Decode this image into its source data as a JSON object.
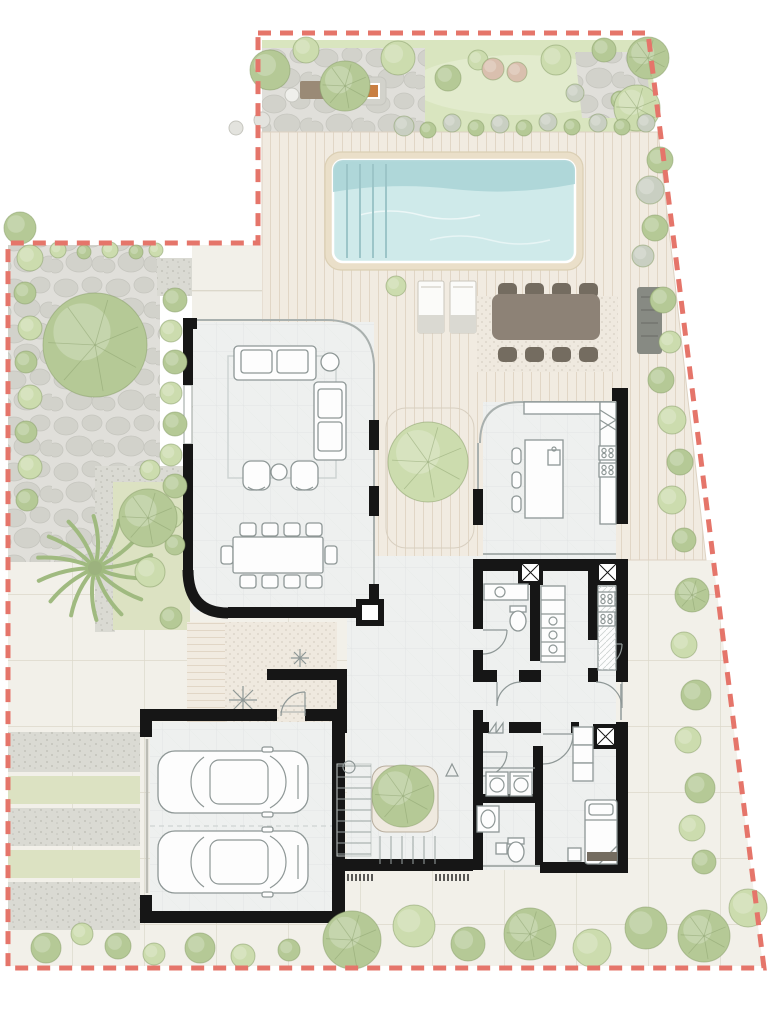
{
  "meta": {
    "title": "villa-landscape-floor-plan",
    "canvas": {
      "width": 768,
      "height": 1019
    }
  },
  "palette": {
    "boundary": "#e5756a",
    "lawn": "#d9e5bf",
    "lawnLight": "#e6eed3",
    "deck": "#f1ebe1",
    "deckLine": "#e1d6c6",
    "pave": "#f2f0e9",
    "paveLine": "#dcd8cb",
    "stoneBase": "#e0dfda",
    "stone": "#d2d2cb",
    "stoneLine": "#c6c6bf",
    "gravel": "#dadad3",
    "gravelDot": "#c3c3bb",
    "bedGreen": "#dce2c2",
    "poolBorder": "#eadfc9",
    "poolWater": "#cfeaea",
    "poolDeep": "#a9d4d6",
    "poolLane": "#9cc5c8",
    "wall": "#161616",
    "floor": "#eef0ef",
    "floorLine": "#e1e5e4",
    "furn": "#8e9796",
    "furnFill": "#fdfdfd",
    "darkTable": "#8d8276",
    "darkChair": "#746c60",
    "benchGrey": "#878a83",
    "treeLight": "#ccdcae",
    "treeMid": "#b5c996",
    "treeDark": "#9cb27e",
    "treeBlush": "#d9bfae",
    "treeGrey": "#c9cfc2",
    "treeLine": "#8aa06c",
    "palm": "#a0ba80",
    "rock": "#e3e3de",
    "rockLine": "#c6c6bf",
    "matCream": "#efe9df",
    "dot": "#d7d0c3",
    "ember": "#c97f42",
    "bbqBrown": "#9a8a76"
  },
  "boundary": {
    "points": "258,33 648,33 764,968 8,968 8,243 258,243 258,33",
    "dash": "13 9",
    "stroke_width": 5
  },
  "pool": {
    "outer": [
      325,
      152,
      258,
      118
    ],
    "inner": [
      333,
      160,
      242,
      102
    ],
    "lanes_x": [
      347,
      360,
      373,
      386
    ],
    "lane_y1": 164,
    "lane_y2": 258
  },
  "loungers": [
    {
      "x": 418,
      "y": 281
    },
    {
      "x": 450,
      "y": 281
    }
  ],
  "outdoor_dining": {
    "rug": [
      477,
      296,
      141,
      76
    ],
    "table": [
      492,
      294,
      108,
      46
    ],
    "chair_xs": [
      498,
      525,
      552,
      579
    ],
    "chair_y_top": 283,
    "chair_y_bottom": 347
  },
  "bench": [
    637,
    287,
    25,
    67
  ],
  "bbq": {
    "counter": [
      300,
      81,
      35,
      18
    ],
    "pit": [
      358,
      77,
      28,
      28
    ],
    "ember": [
      366,
      85,
      12,
      12
    ]
  },
  "driveway_bands": [
    [
      732,
      40,
      "gravel"
    ],
    [
      776,
      28,
      "green"
    ],
    [
      808,
      38,
      "gravel"
    ],
    [
      850,
      28,
      "green"
    ],
    [
      882,
      48,
      "gravel"
    ]
  ],
  "trees": [
    [
      270,
      70,
      20,
      "mid",
      0
    ],
    [
      306,
      50,
      13,
      "light",
      0
    ],
    [
      345,
      86,
      25,
      "mid",
      1
    ],
    [
      398,
      58,
      17,
      "light",
      0
    ],
    [
      448,
      78,
      13,
      "mid",
      0
    ],
    [
      478,
      60,
      10,
      "light",
      0
    ],
    [
      493,
      69,
      11,
      "blush",
      0
    ],
    [
      517,
      72,
      10,
      "blush",
      0
    ],
    [
      556,
      60,
      15,
      "light",
      0
    ],
    [
      604,
      50,
      12,
      "mid",
      0
    ],
    [
      648,
      58,
      21,
      "mid",
      1
    ],
    [
      575,
      93,
      9,
      "grey",
      0
    ],
    [
      620,
      100,
      9,
      "mid",
      0
    ],
    [
      637,
      108,
      23,
      "light",
      1
    ],
    [
      660,
      160,
      13,
      "mid",
      0
    ],
    [
      650,
      190,
      14,
      "grey",
      0
    ],
    [
      655,
      228,
      13,
      "mid",
      0
    ],
    [
      643,
      256,
      11,
      "grey",
      0
    ],
    [
      663,
      300,
      13,
      "mid",
      0
    ],
    [
      670,
      342,
      11,
      "light",
      0
    ],
    [
      661,
      380,
      13,
      "mid",
      0
    ],
    [
      672,
      420,
      14,
      "light",
      0
    ],
    [
      680,
      462,
      13,
      "mid",
      0
    ],
    [
      672,
      500,
      14,
      "light",
      0
    ],
    [
      684,
      540,
      12,
      "mid",
      0
    ],
    [
      692,
      595,
      17,
      "mid",
      1
    ],
    [
      684,
      645,
      13,
      "light",
      0
    ],
    [
      696,
      695,
      15,
      "mid",
      0
    ],
    [
      688,
      740,
      13,
      "light",
      0
    ],
    [
      700,
      788,
      15,
      "mid",
      0
    ],
    [
      692,
      828,
      13,
      "light",
      0
    ],
    [
      704,
      862,
      12,
      "mid",
      0
    ],
    [
      352,
      940,
      29,
      "mid",
      1
    ],
    [
      414,
      926,
      21,
      "light",
      0
    ],
    [
      468,
      944,
      17,
      "mid",
      0
    ],
    [
      530,
      934,
      26,
      "mid",
      1
    ],
    [
      592,
      948,
      19,
      "light",
      0
    ],
    [
      646,
      928,
      21,
      "mid",
      0
    ],
    [
      704,
      936,
      26,
      "mid",
      1
    ],
    [
      748,
      908,
      19,
      "light",
      0
    ],
    [
      46,
      948,
      15,
      "mid",
      0
    ],
    [
      82,
      934,
      11,
      "light",
      0
    ],
    [
      118,
      946,
      13,
      "mid",
      0
    ],
    [
      154,
      954,
      11,
      "light",
      0
    ],
    [
      200,
      948,
      15,
      "mid",
      0
    ],
    [
      243,
      956,
      12,
      "light",
      0
    ],
    [
      289,
      950,
      11,
      "mid",
      0
    ],
    [
      20,
      228,
      16,
      "mid",
      0
    ],
    [
      30,
      258,
      13,
      "light",
      0
    ],
    [
      25,
      293,
      11,
      "mid",
      0
    ],
    [
      30,
      328,
      12,
      "light",
      0
    ],
    [
      26,
      362,
      11,
      "mid",
      0
    ],
    [
      30,
      397,
      12,
      "light",
      0
    ],
    [
      26,
      432,
      11,
      "mid",
      0
    ],
    [
      30,
      467,
      12,
      "light",
      0
    ],
    [
      27,
      500,
      11,
      "mid",
      0
    ],
    [
      58,
      250,
      8,
      "light",
      0
    ],
    [
      84,
      252,
      7,
      "mid",
      0
    ],
    [
      110,
      250,
      8,
      "light",
      0
    ],
    [
      136,
      252,
      7,
      "mid",
      0
    ],
    [
      156,
      250,
      7,
      "light",
      0
    ],
    [
      175,
      300,
      12,
      "mid",
      0
    ],
    [
      171,
      331,
      11,
      "light",
      0
    ],
    [
      175,
      362,
      12,
      "mid",
      0
    ],
    [
      171,
      393,
      11,
      "light",
      0
    ],
    [
      175,
      424,
      12,
      "mid",
      0
    ],
    [
      171,
      455,
      11,
      "light",
      0
    ],
    [
      175,
      486,
      12,
      "mid",
      0
    ],
    [
      172,
      517,
      11,
      "light",
      0
    ],
    [
      175,
      545,
      10,
      "mid",
      0
    ],
    [
      404,
      126,
      10,
      "grey",
      0
    ],
    [
      428,
      130,
      8,
      "mid",
      0
    ],
    [
      452,
      123,
      9,
      "grey",
      0
    ],
    [
      476,
      128,
      8,
      "mid",
      0
    ],
    [
      500,
      124,
      9,
      "grey",
      0
    ],
    [
      524,
      128,
      8,
      "mid",
      0
    ],
    [
      548,
      122,
      9,
      "grey",
      0
    ],
    [
      572,
      127,
      8,
      "mid",
      0
    ],
    [
      598,
      123,
      9,
      "grey",
      0
    ],
    [
      622,
      127,
      8,
      "mid",
      0
    ],
    [
      646,
      123,
      9,
      "grey",
      0
    ],
    [
      95,
      345,
      52,
      "mid",
      1
    ],
    [
      428,
      462,
      40,
      "light",
      1
    ],
    [
      403,
      796,
      31,
      "mid",
      1
    ],
    [
      148,
      518,
      29,
      "mid",
      1
    ],
    [
      150,
      572,
      15,
      "light",
      0
    ],
    [
      171,
      618,
      11,
      "mid",
      0
    ],
    [
      150,
      470,
      10,
      "light",
      0
    ],
    [
      396,
      286,
      10,
      "light",
      0
    ]
  ],
  "rocks": [
    [
      252,
      352,
      10
    ],
    [
      246,
      388,
      8
    ],
    [
      254,
      420,
      9
    ],
    [
      247,
      452,
      7
    ],
    [
      236,
      128,
      7
    ],
    [
      262,
      120,
      8
    ]
  ],
  "indoor_dining": {
    "table": [
      233,
      537,
      90,
      36
    ],
    "chair_xs": [
      240,
      262,
      284,
      306
    ],
    "chair_y_top": 523,
    "chair_y_bottom": 575,
    "end_chairs": [
      [
        221,
        546
      ],
      [
        325,
        546
      ]
    ]
  },
  "stairs": {
    "x1": 337,
    "x2": 371,
    "y_start": 766,
    "step": 11,
    "count": 9,
    "lower_y1": 836,
    "lower_y2": 864,
    "lower_x_start": 380,
    "lower_step": 11,
    "lower_count": 6
  },
  "entry_mats": [
    {
      "x": 336,
      "y": 874,
      "w": 38
    },
    {
      "x": 436,
      "y": 874,
      "w": 34
    }
  ],
  "cars": [
    {
      "x": 158,
      "y": 751
    },
    {
      "x": 158,
      "y": 831
    }
  ],
  "x_columns": [
    [
      518,
      560
    ],
    [
      595,
      560
    ],
    [
      593,
      724
    ]
  ],
  "features": [
    "property-boundary",
    "lawn",
    "barbecue-area",
    "flagstone-patio",
    "large-tree",
    "palm-tree",
    "swimming-pool",
    "pool-deck",
    "sun-loungers",
    "outdoor-dining-set",
    "outdoor-bench",
    "planting-bed",
    "gravel-driveway",
    "hedge-rows",
    "living-room",
    "dining-area",
    "kitchen-island",
    "pantry",
    "powder-room",
    "scullery",
    "laundry",
    "bathroom",
    "bedroom",
    "entry-courtyard",
    "staircase",
    "double-garage"
  ]
}
